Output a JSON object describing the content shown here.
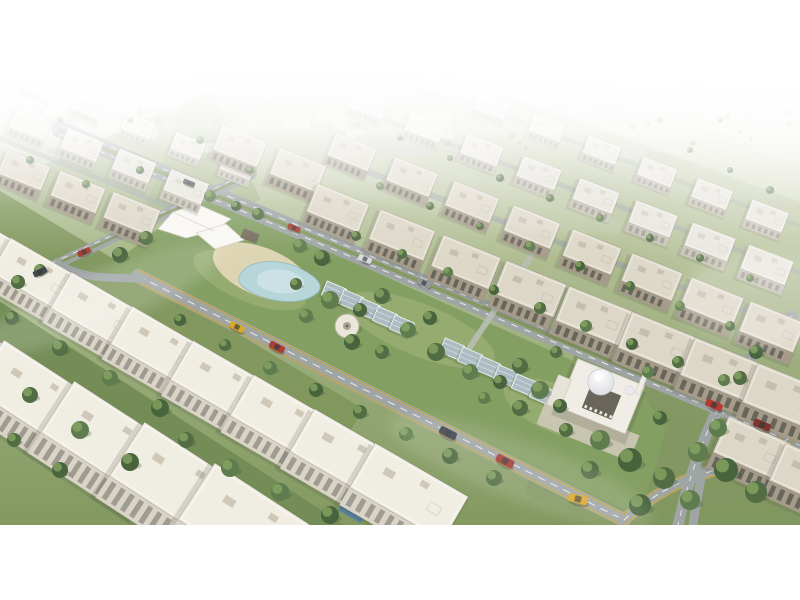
{
  "image": {
    "description": "Aerial 3D architectural rendering of a residential compound: diagonal rows of white and beige low-rise apartment buildings, a central landscaped park with a white shade canopy, sandy plaza, curved pond, rows of glass pergolas, a domed mosque, tree-lined avenues with cars, horizon fading into white haze",
    "style": "photorealistic 3d render, oblique aerial view",
    "contains_text": false
  },
  "canvas": {
    "width": 800,
    "height": 600,
    "margin_color": "#ffffff",
    "photo_band": {
      "top": 72,
      "bottom": 525
    }
  },
  "palette": {
    "margin": "#ffffff",
    "ground_top": "#f3f4ef",
    "ground_mid1": "#b7c295",
    "ground_mid2": "#94a873",
    "ground_bottom": "#7d9458",
    "park_grass": "#7d9a5a",
    "park_patch": "#a3b377",
    "road": "#9aa0a1",
    "road_dash": "#ebebe6",
    "road_median": "#7f9355",
    "road_edge_yellow": "#c9a227",
    "water": "#b4d4d9",
    "water_hi": "#d2e6e8",
    "sand": "#dbd2ae",
    "tent": "#f8f7f3",
    "tent_edge": "#d3cfc5",
    "pergola_glass": "#a7b9c0",
    "pergola_frame": "#eef1f0",
    "gazebo": "#e9e5d8",
    "gazebo_edge": "#b2ab99",
    "pool": "#4e7e9b",
    "tree": [
      "#49663a",
      "#567545",
      "#3f5c33"
    ],
    "tree_hi": "#84a45c",
    "tree_shadow": "#2f4026",
    "distant": [
      "#dcdad1",
      "#e6e4db",
      "#d1cfc5",
      "#c9c7bc"
    ],
    "distant_tree": "#8ba26c",
    "dome": "#e9eaee",
    "dome_edge": "#c5c8cf",
    "mosque_body": "#f0ede5",
    "mosque_trim": "#c6c0b2",
    "mosque_court": "#615d53",
    "mosque_plaza": "#ccc5b4",
    "car_glass": "#2a2e33",
    "buildings": {
      "white": {
        "roof": "#f0ece2",
        "face": "#d8d2c5",
        "win": "#8f8c80",
        "unit": "#cdc6b5",
        "shadow": "#3c4435"
      },
      "beige": {
        "roof": "#dcd5c5",
        "face": "#a19683",
        "win": "#55544b",
        "unit": "#c2bba9",
        "shadow": "#3c4435"
      },
      "light": {
        "roof": "#e5e2d8",
        "face": "#c0bbae",
        "win": "#8e8b80",
        "unit": "#d2cdbf",
        "shadow": "#4a5243"
      }
    }
  },
  "scene": {
    "distant": {
      "y_top": 73,
      "y_bottom": 148,
      "block_count": 64,
      "tree_count": 42
    },
    "distant_dome": {
      "x": 757,
      "y": 117
    },
    "green_zones": [
      {
        "name": "midground-tint",
        "x": 540,
        "y": 235,
        "w": 760,
        "h": 240,
        "rot": 20,
        "c": "#a2b284",
        "o": 0.4
      },
      {
        "name": "park-head-green",
        "x": 90,
        "y": 210,
        "w": 320,
        "h": 120,
        "rot": -24,
        "c": "#93a873",
        "o": 0.5
      },
      {
        "name": "left-garden-strip",
        "x": 160,
        "y": 330,
        "w": 430,
        "h": 74,
        "rot": 31,
        "c": "#7a9154",
        "o": 0.95
      },
      {
        "name": "foreground-garden-strip",
        "x": 140,
        "y": 452,
        "w": 500,
        "h": 100,
        "rot": 33,
        "c": "#6d874e",
        "o": 1
      },
      {
        "name": "southeast-green",
        "x": 700,
        "y": 478,
        "w": 320,
        "h": 150,
        "rot": 20,
        "c": "#7b9158",
        "o": 0.95
      }
    ],
    "park": {
      "points": "108,268 205,192 300,238 420,292 540,346 642,392 666,430 640,516 520,462 400,408 280,352 160,296",
      "patches": [
        {
          "x": 250,
          "y": 280,
          "rx": 60,
          "ry": 22,
          "rot": 22
        },
        {
          "x": 420,
          "y": 330,
          "rx": 80,
          "ry": 26,
          "rot": 22
        },
        {
          "x": 560,
          "y": 410,
          "rx": 60,
          "ry": 24,
          "rot": 22
        }
      ],
      "sand": {
        "x": 262,
        "y": 272,
        "rx": 52,
        "ry": 24,
        "rot": 22
      },
      "pond_outer": "M 242 272 C 252 258 284 259 301 269 C 319 278 327 288 313 296 C 296 306 267 301 251 292 C 240 286 235 280 242 272 Z",
      "pond_inner": "M 258 275 C 268 267 288 268 298 275 C 308 281 306 289 295 292 C 281 296 264 291 257 284 Z"
    },
    "roads": [
      {
        "name": "upper-avenue",
        "d": "M 60 130 L 800 441",
        "w": 17,
        "marks": [
          {
            "c": "#7f9355",
            "w": 3.5,
            "dy": 0
          },
          {
            "c": "#ebebe6",
            "w": 1,
            "dash": "6 8",
            "dy": -4.5
          },
          {
            "c": "#ebebe6",
            "w": 1,
            "dash": "6 8",
            "dy": 4.5
          }
        ]
      },
      {
        "name": "lower-avenue",
        "d": "M 138 276 L 624 520",
        "w": 14,
        "marks": [
          {
            "c": "#ebebe6",
            "w": 1,
            "dash": "7 7",
            "dy": 0
          },
          {
            "c": "#c9a227",
            "w": 1.2,
            "dy": -6
          },
          {
            "c": "#c9a227",
            "w": 1.2,
            "dy": 6
          }
        ]
      },
      {
        "name": "lower-avenue-curve",
        "d": "M 624 520 C 660 488 690 477 722 468 C 756 458 782 445 800 430",
        "w": 12,
        "marks": [
          {
            "c": "#ebebe6",
            "w": 1,
            "dash": "6 6",
            "dy": 0
          },
          {
            "c": "#c9a227",
            "w": 1.2,
            "dy": -5.5
          },
          {
            "c": "#c9a227",
            "w": 1.2,
            "dy": 5.5
          }
        ]
      },
      {
        "name": "south-spur",
        "d": "M 702 471 C 699 491 695 509 693 525",
        "w": 9,
        "marks": []
      },
      {
        "name": "head-cross-street",
        "d": "M 252 174 L 0 290",
        "w": 10,
        "marks": [
          {
            "c": "#7f9355",
            "w": 2.4,
            "dy": 0
          },
          {
            "c": "#ebebe6",
            "w": 0.9,
            "dash": "5 7",
            "dy": -3
          }
        ]
      },
      {
        "name": "head-connector",
        "d": "M 58 264 C 90 282 112 276 140 279",
        "w": 8,
        "marks": []
      },
      {
        "name": "right-cross-street",
        "d": "M 792 316 C 740 358 702 420 678 525",
        "w": 11,
        "marks": [
          {
            "c": "#ebebe6",
            "w": 0.9,
            "dash": "5 7",
            "dy": 0
          }
        ]
      },
      {
        "name": "park-walkway",
        "d": "M 540 243 L 470 347",
        "w": 6,
        "c": "#b6bab0",
        "o": 0.9,
        "marks": []
      },
      {
        "name": "upper-row-street-1",
        "d": "M 344 163 L 800 331",
        "w": 6,
        "o": 0.7,
        "marks": []
      },
      {
        "name": "upper-row-street-2",
        "d": "M 366 113 L 800 273",
        "w": 5,
        "o": 0.55,
        "marks": []
      },
      {
        "name": "upper-row-street-3",
        "d": "M 384 71 L 800 226",
        "w": 4,
        "o": 0.45,
        "marks": []
      },
      {
        "name": "left-top-street",
        "d": "M -20 130 L 172 208",
        "w": 5,
        "o": 0.6,
        "marks": []
      }
    ],
    "tent": {
      "panels": [
        "158,229 173,212 197,204 231,219 214,231 186,238",
        "196,233 226,224 244,240 215,249"
      ],
      "ridge": "M 173 212 L 214 231"
    },
    "kiosk": {
      "x": 250,
      "y": 236,
      "w": 17,
      "h": 10,
      "rot": 22,
      "c": "#6e6456"
    },
    "gazebo": {
      "x": 347,
      "y": 326,
      "r": 12
    },
    "pergola_rows": [
      {
        "x": 334,
        "y": 292,
        "dx": 17,
        "dy": 8.5,
        "n": 5,
        "rot": 23,
        "w": 21,
        "h": 15
      },
      {
        "x": 452,
        "y": 349,
        "dx": 18,
        "dy": 9,
        "n": 6,
        "rot": 23,
        "w": 21,
        "h": 15
      }
    ],
    "pool": {
      "x": 352,
      "y": 512,
      "w": 26,
      "h": 11,
      "rot": 30
    },
    "mosque": {
      "x": 600,
      "y": 400,
      "rot": 22
    },
    "building_rows": [
      {
        "name": "left-top-row-3",
        "style": "light",
        "sx": -12,
        "sy": 66,
        "dx": 50,
        "dy": 20,
        "count": 6,
        "w": 50,
        "dpt": 28,
        "fh": 11,
        "rot": 21,
        "s0": 0.58,
        "s1": 0.66
      },
      {
        "name": "left-top-row-2",
        "style": "light",
        "sx": -22,
        "sy": 103,
        "dx": 52,
        "dy": 21,
        "count": 5,
        "w": 54,
        "dpt": 30,
        "fh": 12,
        "rot": 22,
        "s0": 0.68,
        "s1": 0.76
      },
      {
        "name": "left-top-row-1",
        "style": "beige",
        "sx": -30,
        "sy": 148,
        "dx": 54,
        "dy": 22,
        "count": 4,
        "w": 58,
        "dpt": 32,
        "fh": 13,
        "rot": 22,
        "s0": 0.78,
        "s1": 0.88
      },
      {
        "name": "center-beige-row-4",
        "style": "light",
        "sx": 382,
        "sy": 62,
        "dx": 55,
        "dy": 22,
        "count": 8,
        "w": 52,
        "dpt": 28,
        "fh": 11,
        "rot": 21,
        "s0": 0.56,
        "s1": 0.76
      },
      {
        "name": "center-beige-row-3",
        "style": "light",
        "sx": 368,
        "sy": 104,
        "dx": 57,
        "dy": 23,
        "count": 8,
        "w": 56,
        "dpt": 30,
        "fh": 12,
        "rot": 21,
        "s0": 0.64,
        "s1": 0.86
      },
      {
        "name": "center-beige-row-2",
        "style": "beige",
        "sx": 352,
        "sy": 152,
        "dx": 60,
        "dy": 25,
        "count": 8,
        "w": 60,
        "dpt": 33,
        "fh": 13,
        "rot": 22,
        "s0": 0.74,
        "s1": 0.98
      },
      {
        "name": "park-head-row",
        "style": "beige",
        "sx": 240,
        "sy": 146,
        "dx": 58,
        "dy": 24,
        "count": 2,
        "w": 60,
        "dpt": 34,
        "fh": 13,
        "rot": 22,
        "s0": 0.8,
        "s1": 0.84
      },
      {
        "name": "center-beige-row-1",
        "style": "beige",
        "sx": 338,
        "sy": 208,
        "dx": 64,
        "dy": 27,
        "count": 8,
        "w": 66,
        "dpt": 36,
        "fh": 14,
        "rot": 22,
        "s0": 0.85,
        "s1": 1.18
      },
      {
        "name": "right-edge-row",
        "style": "beige",
        "sx": 752,
        "sy": 448,
        "dx": 58,
        "dy": 28,
        "count": 2,
        "w": 62,
        "dpt": 36,
        "fh": 15,
        "rot": 24,
        "s0": 1.1,
        "s1": 1.15
      },
      {
        "name": "left-white-row-mid",
        "style": "white",
        "sx": -25,
        "sy": 240,
        "dx": 62,
        "dy": 36,
        "count": 8,
        "w": 84,
        "dpt": 40,
        "fh": 16,
        "rot": 30,
        "s0": 0.95,
        "s1": 1.28
      },
      {
        "name": "left-white-row-foreground",
        "style": "white",
        "sx": -35,
        "sy": 352,
        "dx": 72,
        "dy": 44,
        "count": 5,
        "w": 100,
        "dpt": 50,
        "fh": 20,
        "rot": 33,
        "s0": 1.1,
        "s1": 1.35
      }
    ],
    "trees": [
      [
        18,
        282,
        7
      ],
      [
        40,
        270,
        6
      ],
      [
        120,
        255,
        8
      ],
      [
        146,
        238,
        7
      ],
      [
        210,
        196,
        6
      ],
      [
        236,
        206,
        5
      ],
      [
        258,
        214,
        6
      ],
      [
        300,
        246,
        7
      ],
      [
        322,
        258,
        8
      ],
      [
        296,
        284,
        6
      ],
      [
        330,
        300,
        9
      ],
      [
        360,
        310,
        7
      ],
      [
        382,
        296,
        8
      ],
      [
        306,
        316,
        7
      ],
      [
        352,
        342,
        8
      ],
      [
        382,
        352,
        7
      ],
      [
        408,
        330,
        8
      ],
      [
        430,
        318,
        7
      ],
      [
        436,
        352,
        9
      ],
      [
        470,
        372,
        8
      ],
      [
        500,
        382,
        7
      ],
      [
        520,
        366,
        8
      ],
      [
        540,
        390,
        9
      ],
      [
        560,
        406,
        7
      ],
      [
        520,
        408,
        8
      ],
      [
        484,
        398,
        6
      ],
      [
        356,
        236,
        5
      ],
      [
        402,
        254,
        5
      ],
      [
        448,
        272,
        5
      ],
      [
        494,
        290,
        5
      ],
      [
        540,
        308,
        6
      ],
      [
        586,
        326,
        6
      ],
      [
        632,
        344,
        6
      ],
      [
        678,
        362,
        6
      ],
      [
        724,
        380,
        6
      ],
      [
        180,
        320,
        6
      ],
      [
        225,
        345,
        6
      ],
      [
        270,
        368,
        7
      ],
      [
        316,
        390,
        7
      ],
      [
        360,
        412,
        7
      ],
      [
        406,
        434,
        7
      ],
      [
        450,
        456,
        8
      ],
      [
        494,
        478,
        8
      ],
      [
        600,
        440,
        10
      ],
      [
        630,
        460,
        12
      ],
      [
        664,
        478,
        11
      ],
      [
        698,
        452,
        10
      ],
      [
        726,
        470,
        12
      ],
      [
        756,
        492,
        11
      ],
      [
        690,
        500,
        10
      ],
      [
        640,
        505,
        11
      ],
      [
        590,
        470,
        9
      ],
      [
        718,
        428,
        9
      ],
      [
        756,
        352,
        7
      ],
      [
        740,
        378,
        7
      ],
      [
        380,
        186,
        4
      ],
      [
        430,
        206,
        4
      ],
      [
        480,
        226,
        4
      ],
      [
        530,
        246,
        5
      ],
      [
        580,
        266,
        5
      ],
      [
        630,
        286,
        5
      ],
      [
        680,
        306,
        5
      ],
      [
        730,
        326,
        5
      ],
      [
        400,
        138,
        3
      ],
      [
        450,
        158,
        3
      ],
      [
        500,
        178,
        4
      ],
      [
        550,
        198,
        4
      ],
      [
        600,
        218,
        4
      ],
      [
        650,
        238,
        4
      ],
      [
        700,
        258,
        4
      ],
      [
        750,
        278,
        4
      ],
      [
        12,
        318,
        7
      ],
      [
        60,
        348,
        8
      ],
      [
        110,
        378,
        8
      ],
      [
        160,
        408,
        9
      ],
      [
        30,
        395,
        8
      ],
      [
        80,
        430,
        9
      ],
      [
        130,
        462,
        9
      ],
      [
        186,
        440,
        8
      ],
      [
        230,
        468,
        9
      ],
      [
        60,
        470,
        8
      ],
      [
        14,
        440,
        7
      ],
      [
        280,
        492,
        9
      ],
      [
        330,
        515,
        9
      ],
      [
        30,
        160,
        4
      ],
      [
        86,
        184,
        4
      ],
      [
        140,
        170,
        4
      ],
      [
        60,
        120,
        3
      ],
      [
        130,
        120,
        3
      ],
      [
        200,
        140,
        4
      ],
      [
        250,
        170,
        4
      ],
      [
        690,
        150,
        3
      ],
      [
        730,
        170,
        3
      ],
      [
        770,
        190,
        4
      ],
      [
        660,
        120,
        3
      ],
      [
        720,
        120,
        3
      ],
      [
        556,
        352,
        6
      ],
      [
        648,
        372,
        6
      ],
      [
        660,
        418,
        7
      ],
      [
        566,
        430,
        7
      ]
    ],
    "cars": [
      {
        "x": 189,
        "y": 183,
        "rot": 23,
        "c": "#3e4348"
      },
      {
        "x": 294,
        "y": 228,
        "rot": 23,
        "c": "#a83226"
      },
      {
        "x": 365,
        "y": 259,
        "rot": 23,
        "c": "#d9dadb"
      },
      {
        "x": 424,
        "y": 283,
        "rot": 23,
        "c": "#8e9296"
      },
      {
        "x": 714,
        "y": 405,
        "rot": 23,
        "c": "#b03028"
      },
      {
        "x": 762,
        "y": 425,
        "rot": 23,
        "c": "#7c2b24"
      },
      {
        "x": 237,
        "y": 327,
        "rot": 27,
        "c": "#d9a41f"
      },
      {
        "x": 277,
        "y": 347,
        "rot": 27,
        "c": "#a8322a"
      },
      {
        "x": 448,
        "y": 433,
        "rot": 27,
        "c": "#33383e"
      },
      {
        "x": 505,
        "y": 461,
        "rot": 27,
        "c": "#9c3129"
      },
      {
        "x": 578,
        "y": 499,
        "rot": 14,
        "c": "#d9a41f"
      },
      {
        "x": 84,
        "y": 252,
        "rot": -25,
        "c": "#a23026"
      },
      {
        "x": 40,
        "y": 272,
        "rot": -25,
        "c": "#3a3f44"
      }
    ],
    "haze_streaks": [
      {
        "x": 100,
        "y": 300,
        "rx": 130,
        "ry": 28,
        "rot": -22,
        "o": 0.16
      },
      {
        "x": 420,
        "y": 185,
        "rx": 210,
        "ry": 24,
        "rot": 12,
        "o": 0.13
      },
      {
        "x": 768,
        "y": 300,
        "rx": 90,
        "ry": 46,
        "rot": 0,
        "o": 0.2
      },
      {
        "x": 520,
        "y": 470,
        "rx": 140,
        "ry": 30,
        "rot": 20,
        "o": 0.12
      }
    ]
  }
}
